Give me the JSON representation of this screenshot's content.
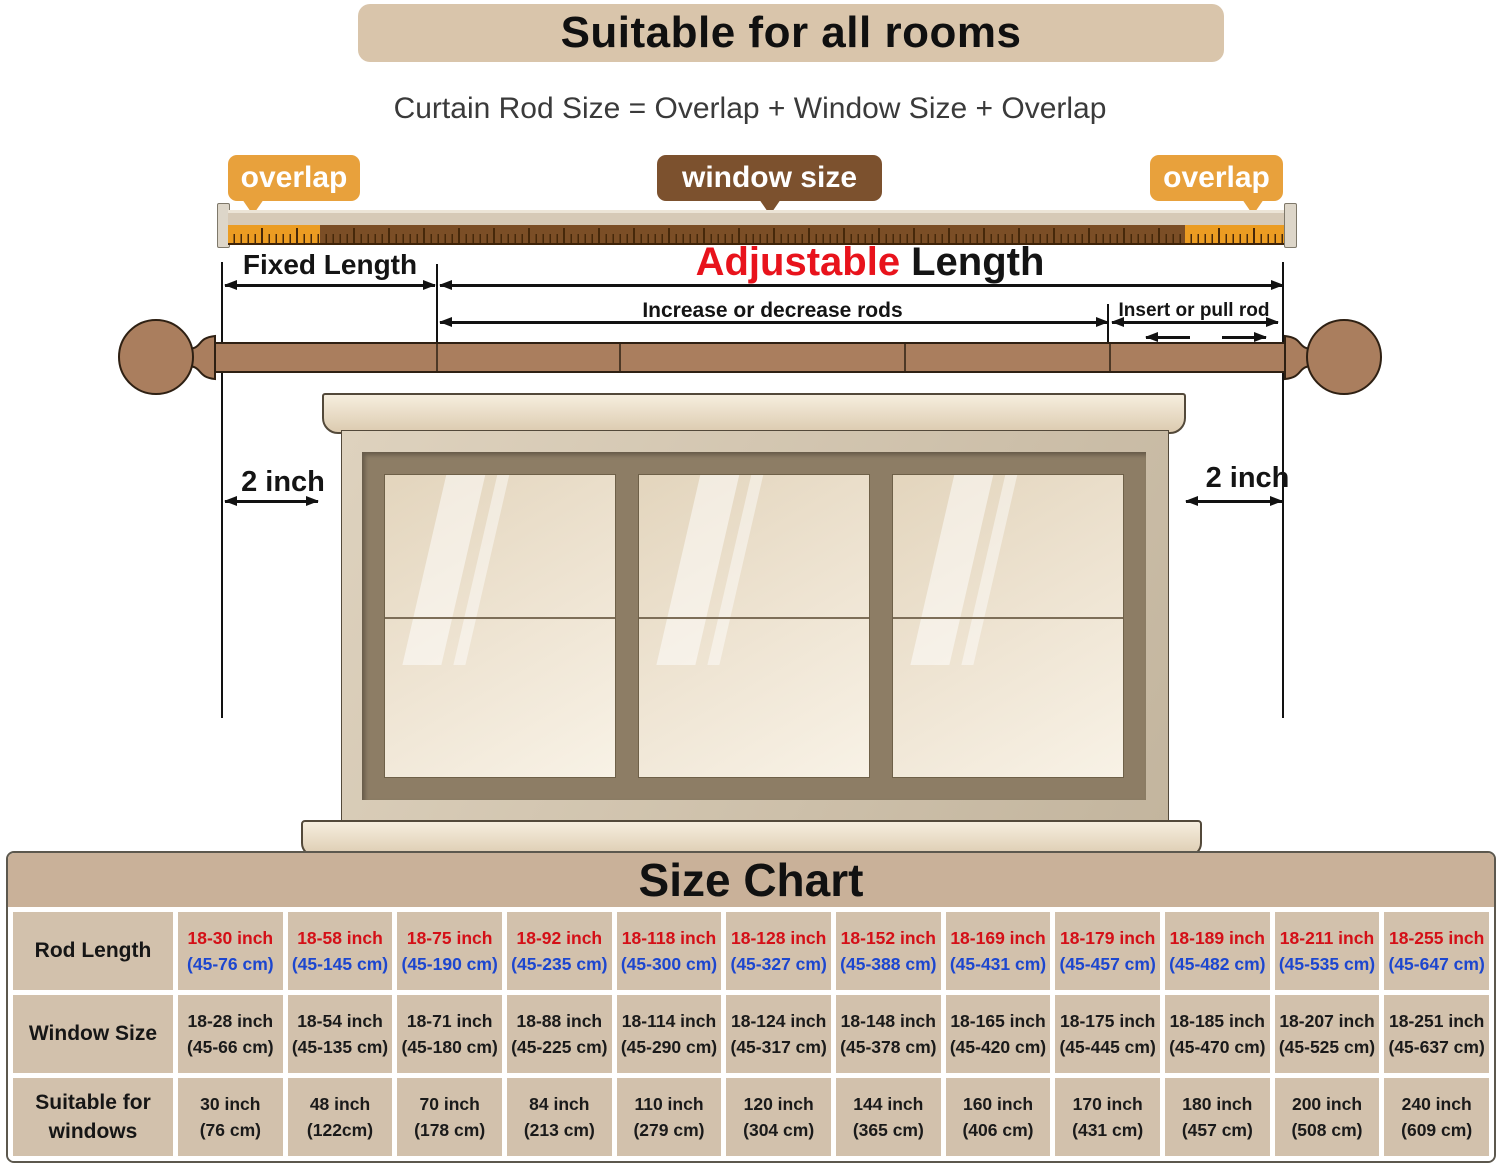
{
  "header": {
    "title": "Suitable for all rooms",
    "formula": "Curtain Rod Size = Overlap + Window Size + Overlap"
  },
  "labels": {
    "overlap_left": "overlap",
    "window_size": "window size",
    "overlap_right": "overlap",
    "fixed_length": "Fixed Length",
    "adjustable": "Adjustable",
    "adjustable_suffix": "Length",
    "increase": "Increase or decrease rods",
    "insert": "Insert or pull rod",
    "two_inch_left": "2 inch",
    "two_inch_right": "2 inch"
  },
  "colors": {
    "banner_bg": "#d9c5ab",
    "overlap_bubble_bg": "#e8a13c",
    "window_size_bubble_bg": "#7c512e",
    "adjustable_red": "#e8131c",
    "rod_brown": "#aa7e5e",
    "ruler_orange": "#eb9c22",
    "ruler_brown": "#7b4e26",
    "table_band_bg": "#c9b199",
    "table_cell_bg": "#d2c1ac",
    "inch_red": "#d40f17",
    "cm_blue": "#1c46cf"
  },
  "size_chart": {
    "title": "Size Chart",
    "rows": [
      {
        "label": "Rod Length",
        "inch_color": "#d40f17",
        "cm_color": "#1c46cf",
        "cells": [
          [
            "18-30 inch",
            "(45-76 cm)"
          ],
          [
            "18-58 inch",
            "(45-145 cm)"
          ],
          [
            "18-75 inch",
            "(45-190 cm)"
          ],
          [
            "18-92 inch",
            "(45-235 cm)"
          ],
          [
            "18-118 inch",
            "(45-300 cm)"
          ],
          [
            "18-128 inch",
            "(45-327 cm)"
          ],
          [
            "18-152 inch",
            "(45-388 cm)"
          ],
          [
            "18-169 inch",
            "(45-431 cm)"
          ],
          [
            "18-179 inch",
            "(45-457 cm)"
          ],
          [
            "18-189 inch",
            "(45-482 cm)"
          ],
          [
            "18-211 inch",
            "(45-535 cm)"
          ],
          [
            "18-255 inch",
            "(45-647 cm)"
          ]
        ]
      },
      {
        "label": "Window Size",
        "inch_color": "#1a1a1a",
        "cm_color": "#1a1a1a",
        "cells": [
          [
            "18-28 inch",
            "(45-66 cm)"
          ],
          [
            "18-54 inch",
            "(45-135 cm)"
          ],
          [
            "18-71 inch",
            "(45-180 cm)"
          ],
          [
            "18-88 inch",
            "(45-225 cm)"
          ],
          [
            "18-114 inch",
            "(45-290 cm)"
          ],
          [
            "18-124 inch",
            "(45-317 cm)"
          ],
          [
            "18-148 inch",
            "(45-378 cm)"
          ],
          [
            "18-165 inch",
            "(45-420 cm)"
          ],
          [
            "18-175 inch",
            "(45-445 cm)"
          ],
          [
            "18-185 inch",
            "(45-470 cm)"
          ],
          [
            "18-207 inch",
            "(45-525 cm)"
          ],
          [
            "18-251 inch",
            "(45-637 cm)"
          ]
        ]
      },
      {
        "label": "Suitable for windows",
        "inch_color": "#1a1a1a",
        "cm_color": "#1a1a1a",
        "cells": [
          [
            "30 inch",
            "(76 cm)"
          ],
          [
            "48 inch",
            "(122cm)"
          ],
          [
            "70 inch",
            "(178 cm)"
          ],
          [
            "84 inch",
            "(213 cm)"
          ],
          [
            "110 inch",
            "(279 cm)"
          ],
          [
            "120 inch",
            "(304 cm)"
          ],
          [
            "144 inch",
            "(365 cm)"
          ],
          [
            "160 inch",
            "(406 cm)"
          ],
          [
            "170 inch",
            "(431 cm)"
          ],
          [
            "180 inch",
            "(457 cm)"
          ],
          [
            "200 inch",
            "(508 cm)"
          ],
          [
            "240 inch",
            "(609 cm)"
          ]
        ]
      }
    ]
  }
}
